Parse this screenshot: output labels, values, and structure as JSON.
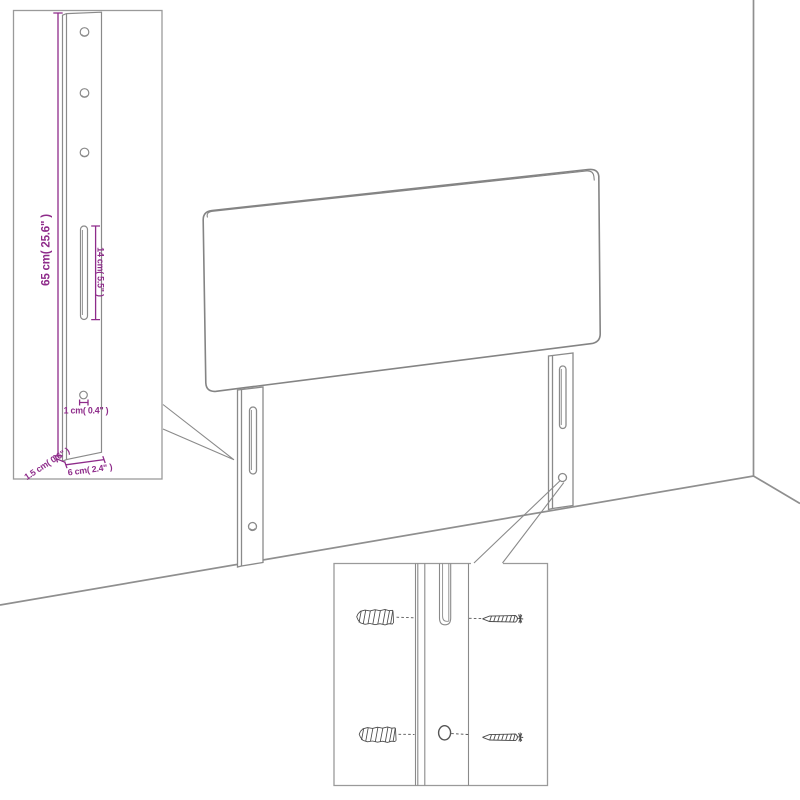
{
  "title": "Headboard wall-mounting technical diagram",
  "colors": {
    "background": "#ffffff",
    "drawing_line": "#8a8a8a",
    "inset_border": "#9a9a9a",
    "hardware_dark": "#4a4a4a",
    "dimension_purple": "#8e2b8a"
  },
  "main_drawing": {
    "subject": "upholstered headboard with two slotted mounting legs standing against a wall corner",
    "elements": [
      "headboard panel",
      "left mounting leg",
      "right mounting leg",
      "wall corner line",
      "floor line"
    ]
  },
  "post_detail_inset": {
    "subject": "enlarged side view of mounting leg",
    "hole_count": 3,
    "dimensions": {
      "post_height": "65 cm( 25.6\" )",
      "slot_length": "14 cm( 5.5\" )",
      "hole_diameter": "1 cm( 0.4\" )",
      "post_width": "6 cm( 2.4\" )",
      "post_thickness": "1.5 cm( 0.6\" )"
    }
  },
  "mounting_detail_inset": {
    "subject": "enlarged view of leg slot and hole aligned with wall anchors and screws",
    "rows": 2,
    "hardware": [
      "wall anchor",
      "screw"
    ]
  }
}
